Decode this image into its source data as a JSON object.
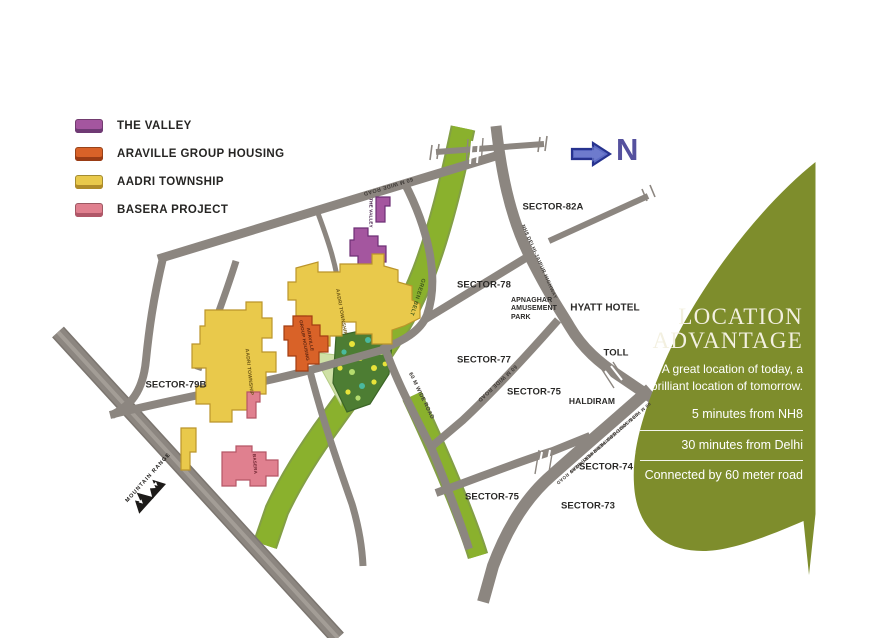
{
  "legend": {
    "items": [
      {
        "label": "THE VALLEY",
        "color": "#a4569f",
        "shade": "#6f3a74"
      },
      {
        "label": "ARAVILLE GROUP HOUSING",
        "color": "#d96228",
        "shade": "#9a3c15"
      },
      {
        "label": "AADRI TOWNSHIP",
        "color": "#e9c94b",
        "shade": "#b08c29"
      },
      {
        "label": "BASERA PROJECT",
        "color": "#e0808f",
        "shade": "#b05768"
      }
    ]
  },
  "compass": {
    "label": "N"
  },
  "map": {
    "sectors": [
      {
        "label": "SECTOR-82A"
      },
      {
        "label": "SECTOR-78"
      },
      {
        "label": "SECTOR-77"
      },
      {
        "label": "SECTOR-75"
      },
      {
        "label": "SECTOR-74"
      },
      {
        "label": "SECTOR-73"
      },
      {
        "label": "SECTOR-75"
      },
      {
        "label": "SECTOR-79B"
      }
    ],
    "landmarks": {
      "hyatt": "HYATT HOTEL",
      "toll": "TOLL",
      "haldiram": "HALDIRAM",
      "apnaghar_l1": "APNAGHAR",
      "apnaghar_l2": "AMUSEMENT",
      "apnaghar_l3": "PARK",
      "mountain": "MOUNTAIN RANGE"
    },
    "roads": {
      "road_60m": "60 M WIDE ROAD",
      "nh8": "NH8 DELHI-JAIPUR HIGHWAY",
      "periphery": "90 M WIDE SOUTHERN PERIPHERY ROAD",
      "green_belt": "GREEN BELT"
    },
    "sites": {
      "valley": "THE VALLEY",
      "araville_l1": "ARAVILLE",
      "araville_l2": "GROUP HOUSING",
      "aadri": "AADRI TOWNSHIP",
      "basera": "BASERA"
    }
  },
  "panel": {
    "title_line1": "LOCATION",
    "title_line2": "ADVANTAGE",
    "subtitle_line1": "A great location of today, a",
    "subtitle_line2": "brilliant location of tomorrow.",
    "points": [
      "5 minutes from NH8",
      "30 minutes from Delhi",
      "Connected by 60 meter road"
    ],
    "bg_color": "#7e8d2c"
  }
}
